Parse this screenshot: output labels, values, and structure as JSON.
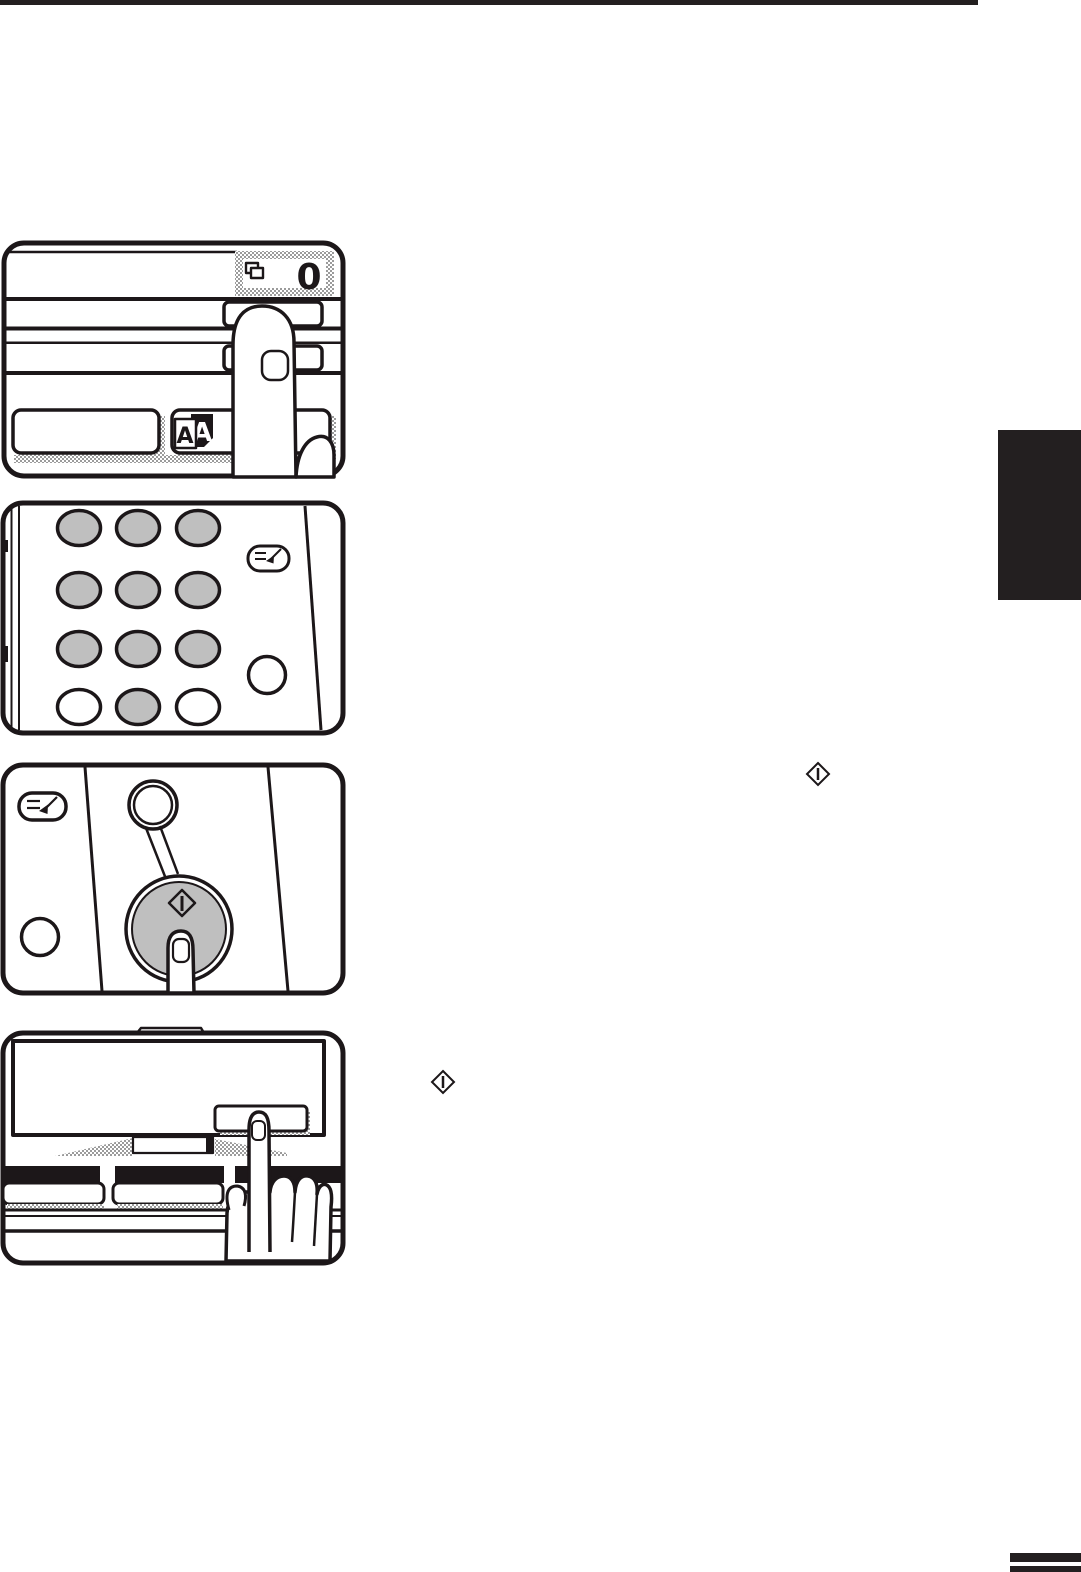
{
  "page": {
    "kind": "copier-operation-manual-page",
    "background": "#ffffff",
    "line_ink": "#1c1719",
    "accent_black": "#231f20",
    "key_gray": "#bfbfbf",
    "hatch_gray": "#9b9b9b"
  },
  "display_figure": {
    "counter_value": "0",
    "original_icon_letter_back": "A",
    "original_icon_letter_front": "A"
  },
  "icons": {
    "copy_quantity": "stacked-pages-icon",
    "original_copy": "a-to-a-pages-icon",
    "interrupt_key": "interrupt-arrow-icon",
    "start_key": "diamond-start-icon",
    "inline_start_symbol_1": "diamond-start-icon",
    "inline_start_symbol_2": "diamond-start-icon"
  }
}
